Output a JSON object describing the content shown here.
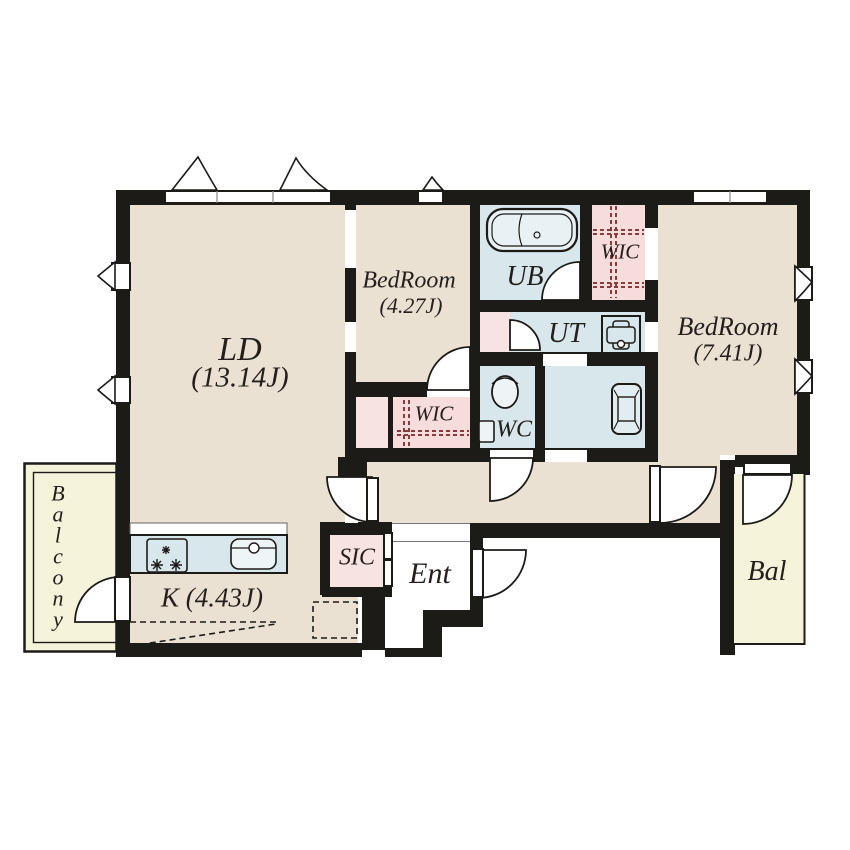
{
  "plan": {
    "rooms": {
      "ld": {
        "name": "LD",
        "size": "(13.14J)"
      },
      "kitchen": {
        "name": "K (4.43J)"
      },
      "bedroom_small": {
        "name": "BedRoom",
        "size": "(4.27J)"
      },
      "bedroom_large": {
        "name": "BedRoom",
        "size": "(7.41J)"
      },
      "wic_bedroom_small": {
        "name": "WIC"
      },
      "wic_bedroom_large": {
        "name": "WIC"
      },
      "unit_bath": {
        "name": "UB"
      },
      "utility": {
        "name": "UT"
      },
      "toilet": {
        "name": "WC"
      },
      "shoe_closet": {
        "name": "SIC"
      },
      "entrance": {
        "name": "Ent"
      },
      "balcony_left": {
        "name": "Balcony"
      },
      "balcony_right": {
        "name": "Bal"
      }
    },
    "colors": {
      "wall": "#1d1b18",
      "room_floor": "#eae1d3",
      "wet_area": "#d8e7ec",
      "closet_pink": "#f7e3e1",
      "wic_pink": "#f6dcda",
      "balcony_yellow": "#f5f3da",
      "label_text": "#241f1c",
      "wic_hanger_dash": "#8a3c3c"
    }
  }
}
